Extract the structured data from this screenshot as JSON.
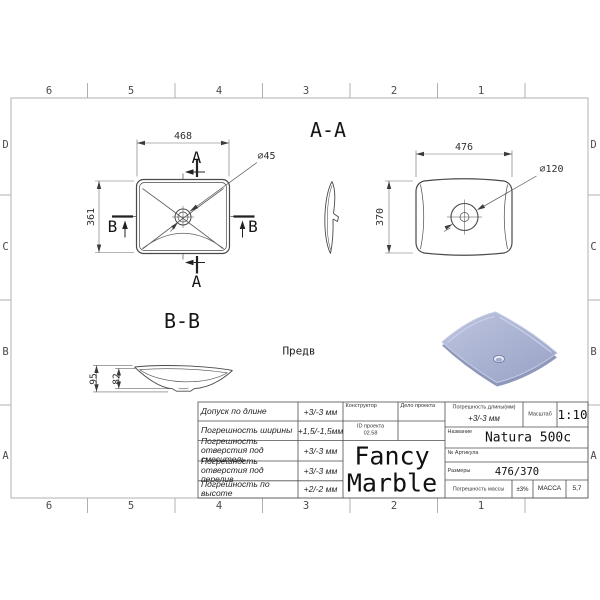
{
  "border": {
    "cols": [
      "6",
      "5",
      "4",
      "3",
      "2",
      "1"
    ],
    "rows": [
      "D",
      "C",
      "B",
      "A"
    ]
  },
  "views": {
    "top": {
      "width": "468",
      "height": "361",
      "drain_dia": "⌀45",
      "cut_a": "A",
      "cut_b": "B"
    },
    "section_aa": {
      "title": "A-A"
    },
    "bottom": {
      "width": "476",
      "height": "370",
      "drain_dia": "⌀120"
    },
    "section_bb": {
      "title": "B-B",
      "height_total": "95",
      "height_inner": "82"
    },
    "preview_label": "Предв"
  },
  "title_block": {
    "tolerances": [
      {
        "label": "Допуск по длине",
        "value": "+3/-3 мм"
      },
      {
        "label": "Погрешность ширины",
        "value": "+1,5/-1,5мм"
      },
      {
        "label": "Погрешность отверстия под смеситель",
        "value": "+3/-3 мм"
      },
      {
        "label": "Погрешность отверстия под перелив",
        "value": "+3/-3 мм"
      },
      {
        "label": "Погрешность по высоте",
        "value": "+2/-2 мм"
      }
    ],
    "designer_label": "Конструктор",
    "project_label": "Дело проекта",
    "project_id_label": "ID проекта",
    "project_id_value": "02.58",
    "company_line1": "Fancy",
    "company_line2": "Marble",
    "length_tol_label": "Погрешность длины(мм)",
    "length_tol_value": "+3/-3 мм",
    "scale_label": "Масштаб",
    "scale_value": "1:10",
    "name_label": "Название",
    "name_value": "Natura 500c",
    "article_label": "№ Артикула",
    "dimensions_label": "Размеры",
    "dimensions_value": "476/370",
    "mass_tol_label": "Погрешность массы",
    "mass_tol_value": "±3%",
    "mass_label": "МАССА",
    "mass_value": "5,7"
  },
  "colors": {
    "line": "#4a4a4a",
    "frame": "#b0b0b0",
    "sink_body": "#a9b2d2",
    "sink_edge": "#c6cce4",
    "sink_shadow": "#8f98ba"
  }
}
